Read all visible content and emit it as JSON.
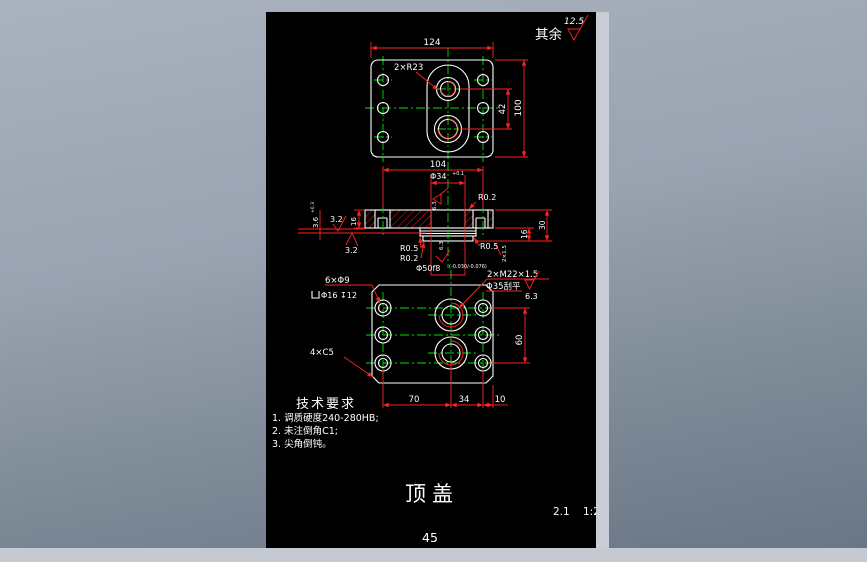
{
  "colors": {
    "sheet_background": "#000000",
    "outline_white": "#ffffff",
    "dimension_red": "#ff2222",
    "centerline_green": "#00e000",
    "desktop_gray_blue": "#99a3b1",
    "edge_strip_gray": "#c9cdd5"
  },
  "corner_note": {
    "text": "其余",
    "roughness": "12.5"
  },
  "top_view": {
    "dim_width": "124",
    "dim_height": "100",
    "dim_hole_spacing": "42",
    "label_slot_radius": "2×R23"
  },
  "section_view": {
    "dim_hole_pitch": "104",
    "dim_bore": "Φ34",
    "dim_bore_tol": "+0.1",
    "roughness_bore": "6.3",
    "label_fillet_top_right": "R0.2",
    "roughness_left_top": "3.2",
    "roughness_left_bottom": "3.2",
    "dim_groove": "3.6",
    "dim_groove_tol": "+0.3",
    "dim_thickness": "16",
    "dim_total_height": "30",
    "dim_boss_height": "16",
    "dim_chamfer": "2×1.5",
    "label_fillet_left_1": "R0.5",
    "label_fillet_left_2": "R0.2",
    "label_fillet_right": "R0.5",
    "roughness_boss": "6.3",
    "dim_boss": "Φ50f8",
    "dim_boss_tol": "(-0.030/-0.076)"
  },
  "bottom_view": {
    "label_holes": "6×Φ9",
    "label_counterbore": "Φ16 ↧12",
    "label_thread": "2×M22×1.5",
    "label_spotface": "Φ35刮平",
    "roughness_spotface": "6.3",
    "label_corner_chamfer": "4×C5",
    "dim_left": "70",
    "dim_mid": "34",
    "dim_right": "10",
    "dim_height": "60"
  },
  "tech_req": {
    "title": "技术要求",
    "items": [
      "1. 调质硬度240-280HB;",
      "2. 未注倒角C1;",
      "3. 尖角倒钝。"
    ]
  },
  "title_block": {
    "part_name": "顶盖",
    "drawing_code": "2.1",
    "scale": "1:2",
    "page_number": "45"
  }
}
